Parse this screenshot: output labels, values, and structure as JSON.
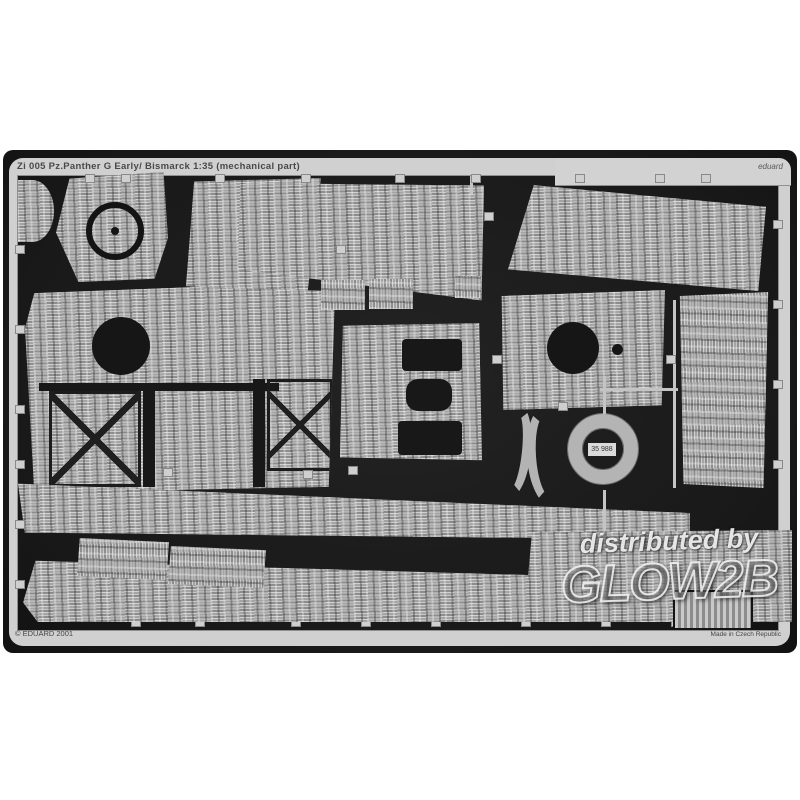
{
  "page": {
    "background": "#ffffff"
  },
  "photo": {
    "description": "product photograph of a black photo-etched metal fret with zimmerit-textured tank armour plates",
    "background_color": "#1b1b1b",
    "frame_color": "#d0d0d0",
    "metal_color": "#b5b5b5",
    "fret_title": "Zi 005  Pz.Panther G Early/ Bismarck 1:35 (mechanical part)",
    "brand_mark": "eduard",
    "copyright_text": "© EDUARD 2001",
    "made_in_text": "Made in Czech Republic",
    "ring_part_label": "35 988",
    "watermark": {
      "line1": "distributed by",
      "line2": "GLOW2B",
      "color": "#f0f0f0"
    },
    "parts": [
      "corner-blob-plate",
      "cupola-plate-with-ring",
      "upper-left-trapezoid-plate",
      "upper-centre-glacis-plate",
      "upper-right-glacis-plate",
      "rear-hull-plate-with-hatch-and-x-braces",
      "small-ladder-plates",
      "centre-plate-with-cutouts",
      "side-plate-with-hatch-hole",
      "tall-right-side-plate",
      "curved-arc-strips",
      "cupola-ring-annulus",
      "long-hull-side-strip-upper",
      "small-vertical-texture-plates",
      "long-hull-side-strip-lower",
      "ribbed-grille-plate"
    ]
  }
}
